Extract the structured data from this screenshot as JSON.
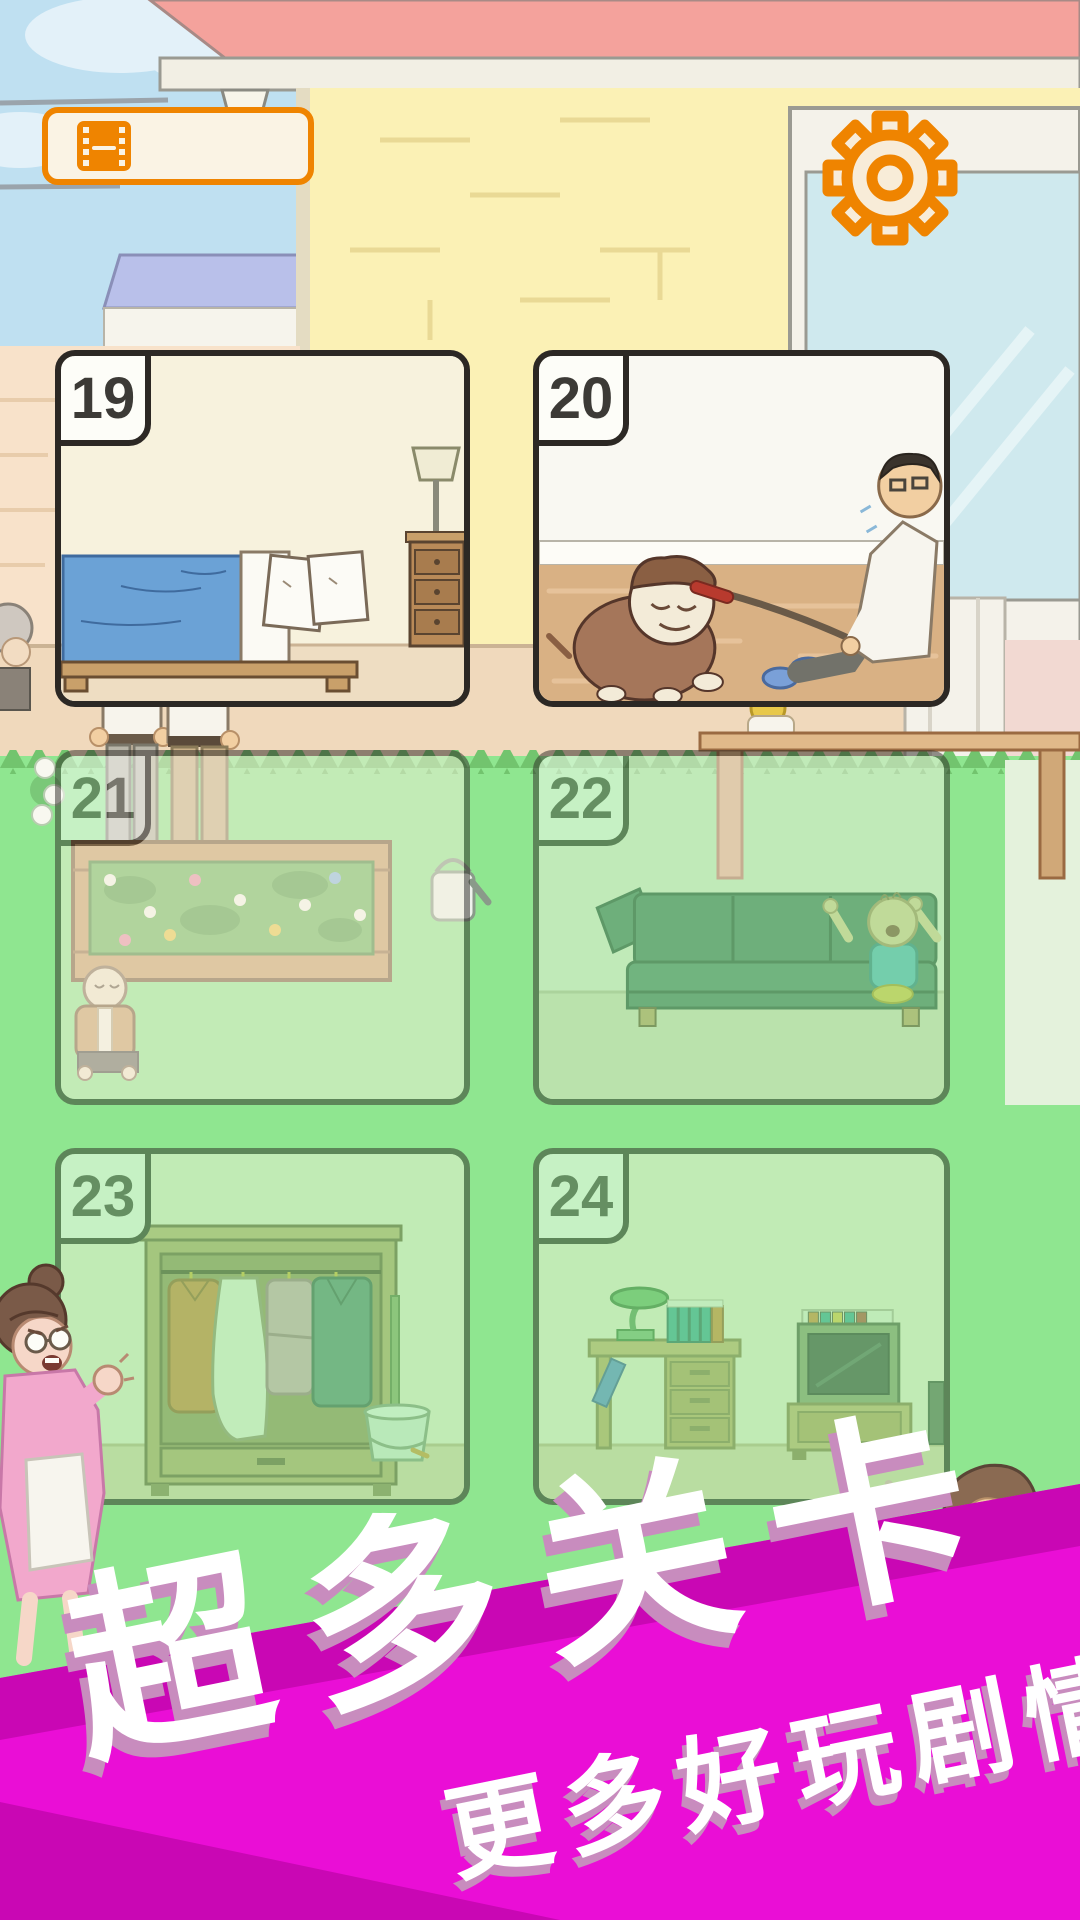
{
  "header": {
    "replay_button": {
      "icon": "film-strip-icon"
    },
    "settings_button": {
      "icon": "gear-icon"
    }
  },
  "levels": [
    {
      "number": "19",
      "locked": false,
      "scene": "bedroom-bed-nightstand-lamp"
    },
    {
      "number": "20",
      "locked": false,
      "scene": "bulldog-pulling-man-on-leash"
    },
    {
      "number": "21",
      "locked": true,
      "scene": "garden-flowerbed-kneeling-man"
    },
    {
      "number": "22",
      "locked": true,
      "scene": "sofa-with-baby"
    },
    {
      "number": "23",
      "locked": true,
      "scene": "wardrobe-clothes-mop-bucket"
    },
    {
      "number": "24",
      "locked": true,
      "scene": "desk-lamp-books-tv"
    }
  ],
  "banner": {
    "headline": "超多关卡",
    "subline": "更多好玩剧情"
  },
  "colors": {
    "accent_orange": "#ef8400",
    "banner_magenta": "#ea0ed6",
    "banner_dark": "#c907b4",
    "lawn_green": "#8fe690",
    "card_border": "#2c2824",
    "wall_yellow": "#fbf1b5",
    "roof_salmon": "#f4a29c"
  }
}
